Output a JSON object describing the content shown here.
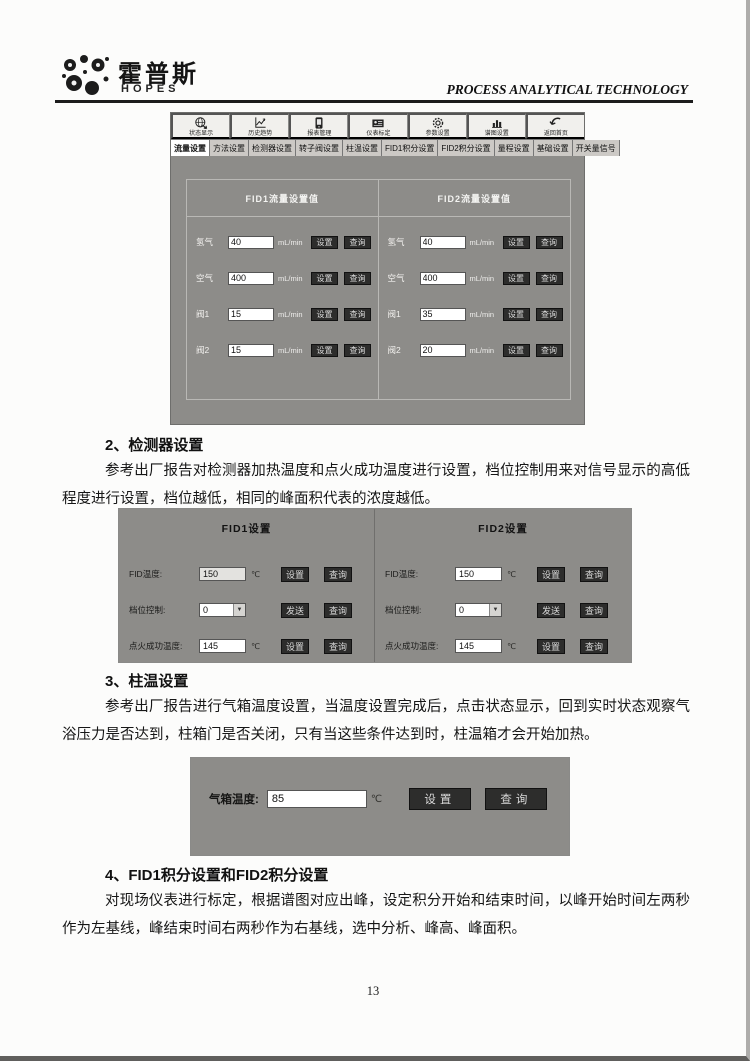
{
  "ui": {
    "set": "设置",
    "query": "查询",
    "send": "发送"
  },
  "header": {
    "logo_cn": "霍普斯",
    "logo_en": "HOPES",
    "tagline": "PROCESS ANALYTICAL TECHNOLOGY"
  },
  "s1": {
    "toolbar": [
      {
        "label": "状态显示"
      },
      {
        "label": "历史趋势"
      },
      {
        "label": "报表管理"
      },
      {
        "label": "仪表标定"
      },
      {
        "label": "参数设置"
      },
      {
        "label": "谱图设置"
      },
      {
        "label": "返回首页"
      }
    ],
    "tabs": [
      {
        "label": "流量设置"
      },
      {
        "label": "方法设置"
      },
      {
        "label": "检测器设置"
      },
      {
        "label": "转子阀设置"
      },
      {
        "label": "柱温设置"
      },
      {
        "label": "FID1积分设置"
      },
      {
        "label": "FID2积分设置"
      },
      {
        "label": "量程设置"
      },
      {
        "label": "基础设置"
      },
      {
        "label": "开关量信号"
      }
    ],
    "flow_unit": "mL/min",
    "panels": [
      {
        "title": "FID1流量设置值",
        "rows": [
          {
            "label": "氢气",
            "value": "40"
          },
          {
            "label": "空气",
            "value": "400"
          },
          {
            "label": "阀1",
            "value": "15"
          },
          {
            "label": "阀2",
            "value": "15"
          }
        ]
      },
      {
        "title": "FID2流量设置值",
        "rows": [
          {
            "label": "氢气",
            "value": "40"
          },
          {
            "label": "空气",
            "value": "400"
          },
          {
            "label": "阀1",
            "value": "35"
          },
          {
            "label": "阀2",
            "value": "20"
          }
        ]
      }
    ]
  },
  "sec2": {
    "heading": "2、检测器设置",
    "body": "参考出厂报告对检测器加热温度和点火成功温度进行设置，档位控制用来对信号显示的高低程度进行设置，档位越低，相同的峰面积代表的浓度越低。"
  },
  "s2": {
    "temp_unit": "℃",
    "panels": [
      {
        "title": "FID1设置",
        "rows": [
          {
            "label": "FID温度:",
            "value": "150"
          },
          {
            "label": "档位控制:",
            "value": "0"
          },
          {
            "label": "点火成功温度:",
            "value": "145"
          }
        ]
      },
      {
        "title": "FID2设置",
        "rows": [
          {
            "label": "FID温度:",
            "value": "150"
          },
          {
            "label": "档位控制:",
            "value": "0"
          },
          {
            "label": "点火成功温度:",
            "value": "145"
          }
        ]
      }
    ]
  },
  "sec3": {
    "heading": "3、柱温设置",
    "body": "参考出厂报告进行气箱温度设置，当温度设置完成后，点击状态显示，回到实时状态观察气浴压力是否达到，柱箱门是否关闭，只有当这些条件达到时，柱温箱才会开始加热。"
  },
  "s3": {
    "label": "气箱温度:",
    "value": "85",
    "unit": "℃"
  },
  "sec4": {
    "heading": "4、FID1积分设置和FID2积分设置",
    "body": "对现场仪表进行标定，根据谱图对应出峰，设定积分开始和结束时间，以峰开始时间左两秒作为左基线，峰结束时间右两秒作为右基线，选中分析、峰高、峰面积。"
  },
  "footer": {
    "page_number": "13"
  }
}
